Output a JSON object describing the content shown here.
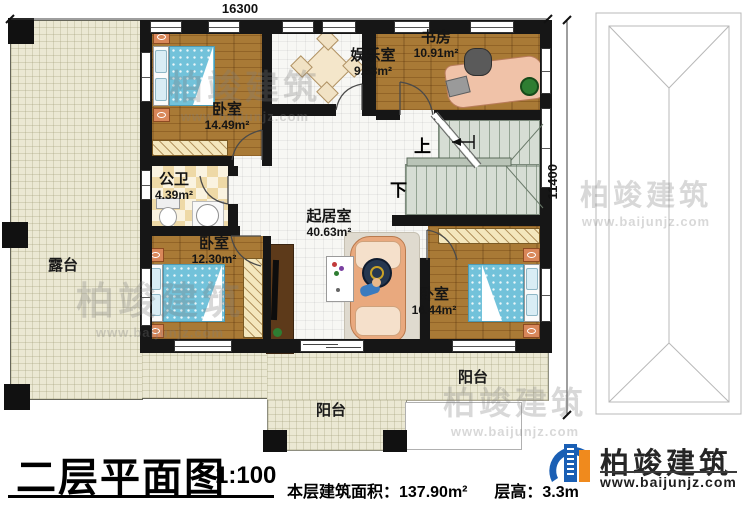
{
  "dims": {
    "width_label": "16300",
    "height_label": "11400"
  },
  "rooms": [
    {
      "name": "卧室",
      "area": "14.49m²"
    },
    {
      "name": "娱乐室",
      "area": "9.63m²"
    },
    {
      "name": "书房",
      "area": "10.91m²"
    },
    {
      "name": "公卫",
      "area": "4.39m²"
    },
    {
      "name": "起居室",
      "area": "40.63m²"
    },
    {
      "name": "卧室",
      "area": "12.30m²"
    },
    {
      "name": "卧室",
      "area": "16.44m²"
    }
  ],
  "outdoor": {
    "terrace_label": "露台",
    "balcony_right_label": "阳台",
    "balcony_bottom_label": "阳台"
  },
  "stairs": {
    "up_label": "上",
    "down_label": "下"
  },
  "watermark": {
    "text": "柏竣建筑",
    "url": "www.baijunjz.com"
  },
  "title_block": {
    "title": "二层平面图",
    "scale": "1:100",
    "area_note": "本层建筑面积：137.90m²",
    "floor_height_note": "层高：3.3m"
  },
  "brand": {
    "name": "柏竣建筑",
    "url": "www.baijunjz.com"
  }
}
